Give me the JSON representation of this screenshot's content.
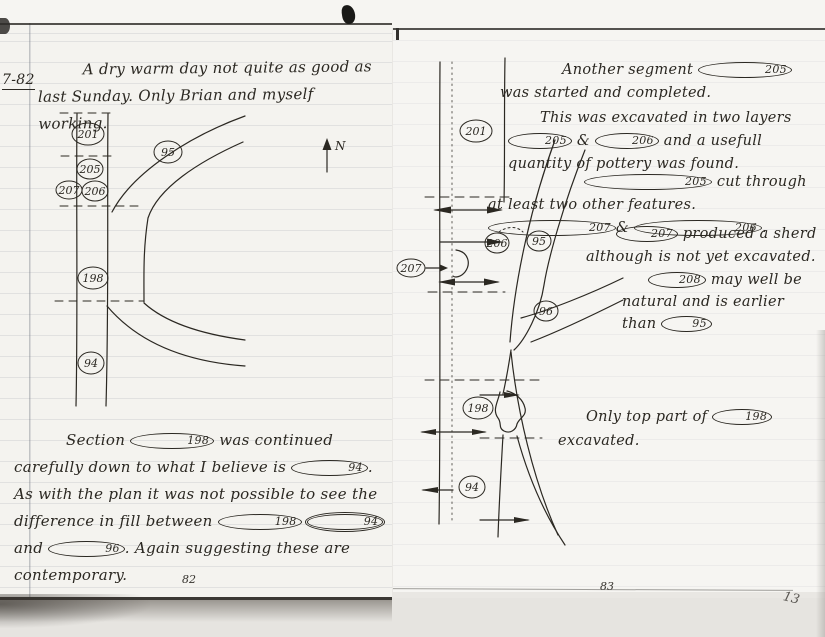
{
  "scan": {
    "left_page_number": "82",
    "right_page_number": "83",
    "corner_mark": "13"
  },
  "left_page": {
    "date": "7-82",
    "entry": "A dry warm day not quite as good as last Sunday. Only Brian and myself working.",
    "section_note": [
      {
        "t": "Section "
      },
      {
        "c": "198"
      },
      {
        "t": " was continued carefully down to what I believe is "
      },
      {
        "c": "94"
      },
      {
        "t": ".  As with the plan it was not possible to see the difference in fill between "
      },
      {
        "c": "198"
      },
      {
        "t": " "
      },
      {
        "c": "94",
        "d": true
      },
      {
        "t": " and "
      },
      {
        "c": "96"
      },
      {
        "t": ".  Again suggesting these are contemporary."
      }
    ],
    "diagram": {
      "n201": "201",
      "n205": "205",
      "n207": "207",
      "n206": "206",
      "n198": "198",
      "n94": "94",
      "n95": "95",
      "north": "N"
    }
  },
  "right_page": {
    "notes": {
      "n1": [
        {
          "t": "Another segment "
        },
        {
          "c": "205"
        },
        {
          "t": " was started and completed."
        }
      ],
      "n2": [
        {
          "t": "This was excavated in two layers "
        },
        {
          "c": "205"
        },
        {
          "t": " & "
        },
        {
          "c": "206"
        },
        {
          "t": " and a usefull quantity of pottery was found."
        }
      ],
      "n3": [
        {
          "c": "205"
        },
        {
          "t": " cut through at least two other features. "
        },
        {
          "c": "207"
        },
        {
          "t": "& "
        },
        {
          "c": "206"
        },
        {
          "t": "."
        }
      ],
      "n4": [
        {
          "c": "207"
        },
        {
          "t": " produced a sherd although is not yet excavated."
        }
      ],
      "n5": [
        {
          "c": "208"
        },
        {
          "t": " may well be natural and is earlier than "
        },
        {
          "c": "95"
        }
      ],
      "n6": [
        {
          "t": "Only top part of "
        },
        {
          "c": "198"
        },
        {
          "t": " excavated."
        }
      ]
    },
    "diagram": {
      "n201": "201",
      "n207": "207",
      "n206": "206",
      "n95": "95",
      "n96": "96",
      "n198": "198",
      "n94": "94"
    }
  }
}
